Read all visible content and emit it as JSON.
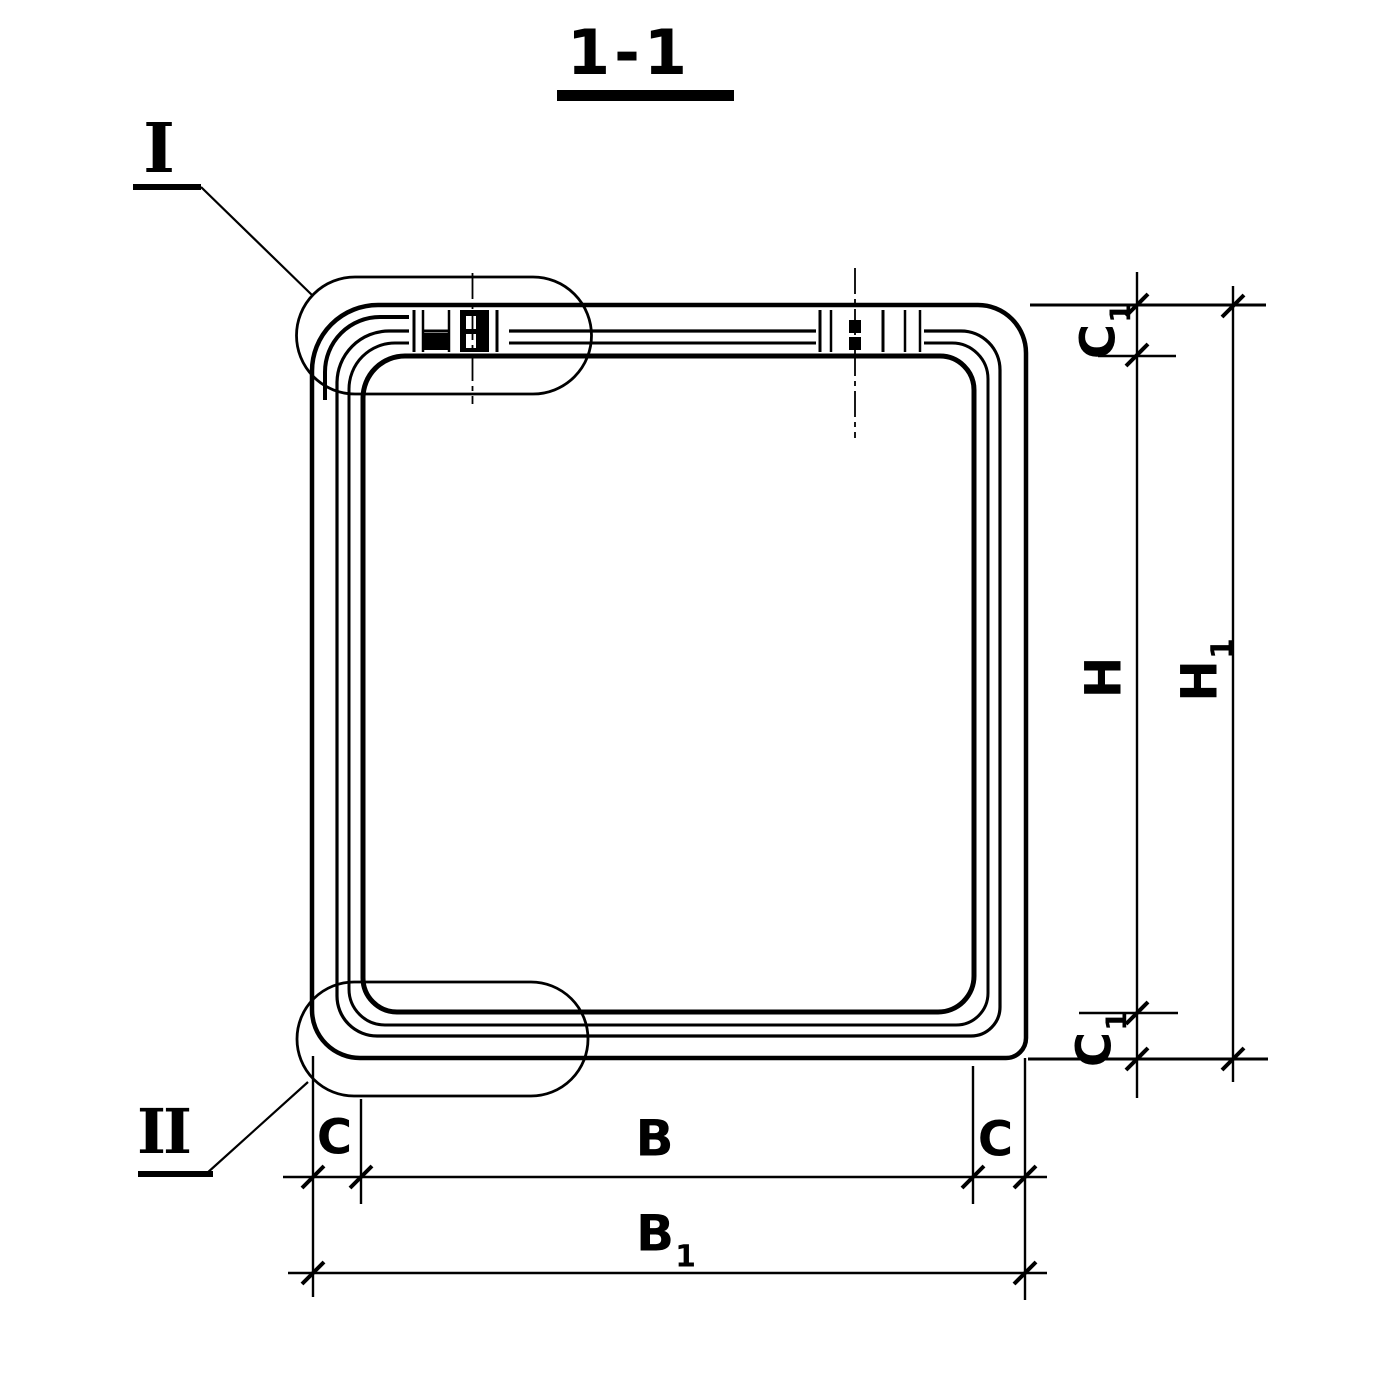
{
  "page": {
    "paper_color": "#ffffff",
    "ink_color": "#000000"
  },
  "title": {
    "label": "1-1"
  },
  "callouts": {
    "detail_i": {
      "label": "I"
    },
    "detail_ii": {
      "label": "II"
    }
  },
  "dimensions": {
    "horizontal": {
      "c_left": {
        "main": "C",
        "sub": ""
      },
      "b": {
        "main": "B",
        "sub": ""
      },
      "c_right": {
        "main": "C",
        "sub": ""
      },
      "b1": {
        "main": "B",
        "sub": "1"
      }
    },
    "vertical": {
      "c1_top": {
        "main": "C",
        "sub": "1"
      },
      "h": {
        "main": "H",
        "sub": ""
      },
      "h1": {
        "main": "H",
        "sub": "1"
      },
      "c1_bottom": {
        "main": "C",
        "sub": "1"
      }
    }
  }
}
